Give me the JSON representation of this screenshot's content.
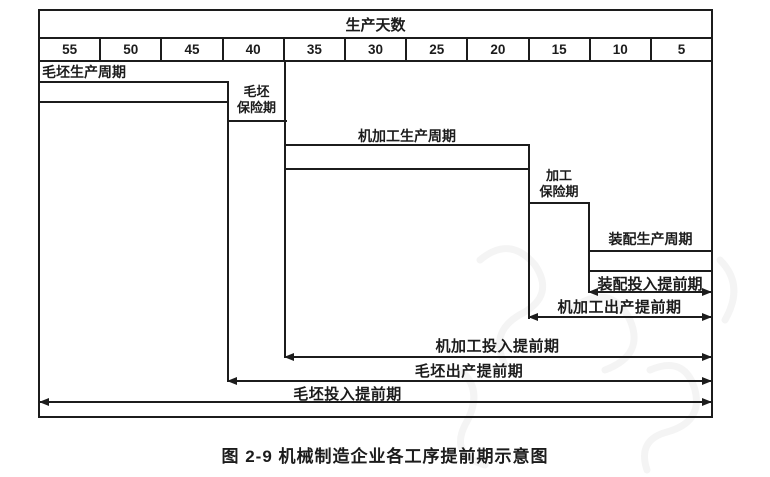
{
  "diagram": {
    "title": "生产天数",
    "scale_ticks": [
      "55",
      "50",
      "45",
      "40",
      "35",
      "30",
      "25",
      "20",
      "15",
      "10",
      "5"
    ],
    "bars": {
      "blank_cycle": "毛坯生产周期",
      "blank_insurance": [
        "毛坯",
        "保险期"
      ],
      "machining_cycle": "机加工生产周期",
      "machining_insurance": [
        "加工",
        "保险期"
      ],
      "assembly_cycle": "装配生产周期"
    },
    "lead_times": {
      "assembly_input": "装配投入提前期",
      "machining_output": "机加工出产提前期",
      "machining_input": "机加工投入提前期",
      "blank_output": "毛坯出产提前期",
      "blank_input": "毛坯投入提前期"
    },
    "caption": "图 2-9  机械制造企业各工序提前期示意图",
    "colors": {
      "ink": "#1c1c1c",
      "paper": "#ffffff"
    }
  }
}
